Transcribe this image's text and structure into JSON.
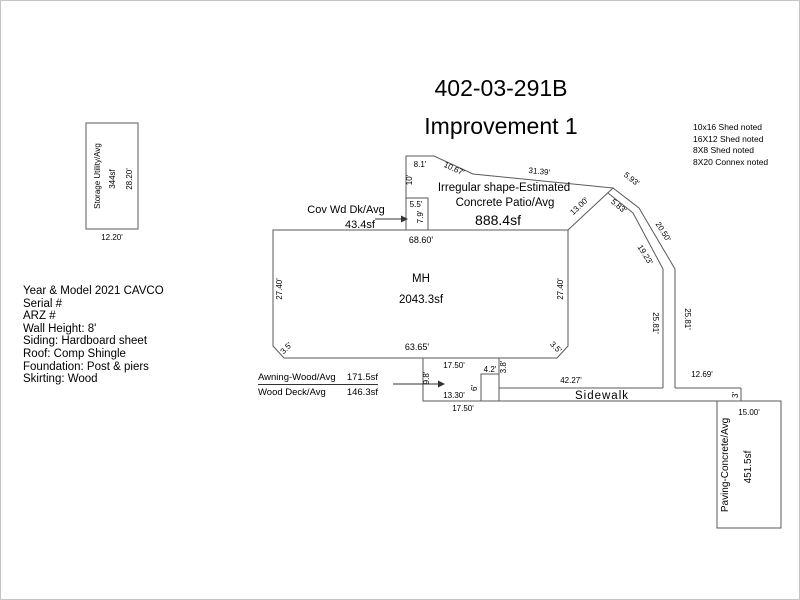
{
  "colors": {
    "background": "#ffffff",
    "line": "#5a5a5a",
    "text": "#000000"
  },
  "header": {
    "parcel_id": "402-03-291B",
    "improvement": "Improvement 1"
  },
  "shed_notes": {
    "lines": [
      "10x16 Shed noted",
      "16X12 Shed noted",
      "8X8 Shed noted",
      "8X20 Connex noted"
    ]
  },
  "property_info": {
    "lines": [
      "Year & Model 2021 CAVCO",
      "Serial #",
      "ARZ #",
      "Wall Height: 8'",
      "Siding: Hardboard sheet",
      "Roof: Comp Shingle",
      "Foundation: Post & piers",
      "Skirting: Wood"
    ]
  },
  "storage": {
    "name": "Storage Utility/Avg",
    "area": "344sf",
    "side_dim": "28.20'",
    "base_dim": "12.20'"
  },
  "mh": {
    "label": "MH",
    "area": "2043.3sf",
    "dim_top": "68.60'",
    "dim_bottom": "63.65'",
    "dim_left": "27.40'",
    "dim_right": "27.40'",
    "dim_corner_left": "3.5'",
    "dim_corner_right": "3.5'"
  },
  "cov_wd_dk": {
    "name": "Cov Wd Dk/Avg",
    "area": "43.4sf",
    "dim_top": "5.5'",
    "dim_side": "7.9'"
  },
  "patio": {
    "desc_line1": "Irregular shape-Estimated",
    "desc_line2": "Concrete Patio/Avg",
    "area": "888.4sf",
    "dim_top": "8.1'",
    "dim_left": "10'",
    "dim_chamfer": "10.67'",
    "dim_long": "31.39'",
    "dim_right": "13.00'",
    "dim_inner_step": "5.83'"
  },
  "walkway": {
    "dim_outer_step": "5.93'",
    "dim_outer_diag": "20.50'",
    "dim_inner_diag": "19.23'",
    "dim_inner_vert": "25.81'",
    "dim_outer_vert": "25.81'"
  },
  "awning_deck": {
    "awning_name": "Awning-Wood/Avg",
    "awning_area": "171.5sf",
    "deck_name": "Wood Deck/Avg",
    "deck_area": "146.3sf",
    "dim_top": "17.50'",
    "dim_left": "9.8'",
    "dim_bottom_inner": "13.30'",
    "dim_bottom_outer": "17.50'",
    "dim_step_top": "4.2'",
    "dim_step_right": "3.8'",
    "dim_step_left": "6'"
  },
  "sidewalk": {
    "label": "Sidewalk",
    "dim_left_run": "42.27'",
    "dim_right_run": "12.69'",
    "dim_end": "3'"
  },
  "paving": {
    "name": "Paving-Concrete/Avg",
    "area": "451.5sf",
    "dim_top": "15.00'"
  }
}
